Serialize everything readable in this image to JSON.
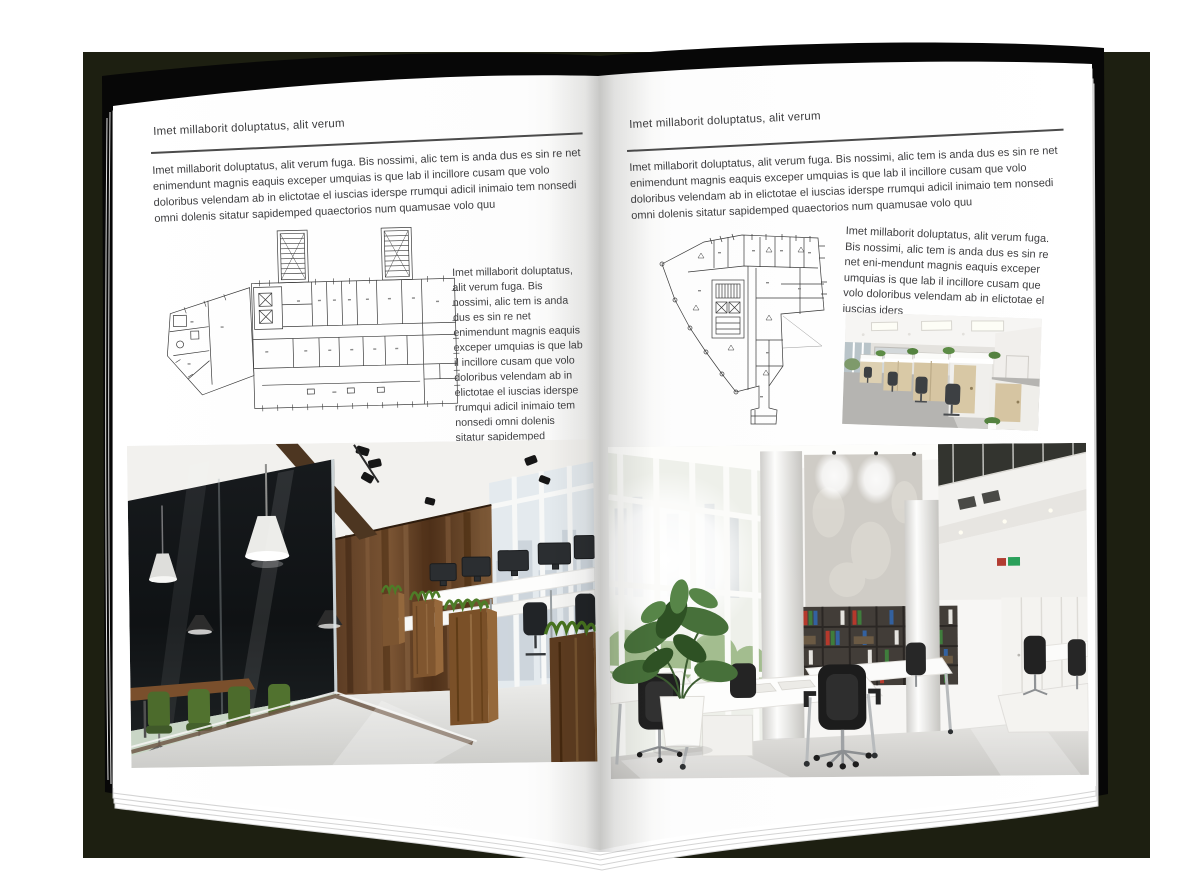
{
  "colors": {
    "backdrop": "#1d1f11",
    "cover": "#070707",
    "page": "#ffffff",
    "text": "#3e3e40"
  },
  "left_page": {
    "header": "Imet millaborit doluptatus, alit verum",
    "intro": "Imet millaborit doluptatus, alit verum fuga. Bis nossimi, alic tem is anda dus es sin re net enimendunt magnis eaquis exceper umquias is que lab il incillore cusam que volo doloribus velendam ab in elictotae el iuscias iderspe rrumqui adicil inimaio tem nonsedi omni dolenis sitatur sapidemped quaectorios num quamusae volo quu",
    "caption": "Imet millaborit doluptatus, alit verum fuga. Bis nossimi, alic tem is anda dus es sin re net enimendunt magnis eaquis exceper umquias is que lab il incillore cusam que volo doloribus velendam ab in elictotae el iuscias iderspe rrumqui adicil inimaio tem nonsedi omni dolenis sitatur sapidemped quaectorios num quamusae volo quu"
  },
  "right_page": {
    "header": "Imet millaborit doluptatus, alit verum",
    "intro": "Imet millaborit doluptatus, alit verum fuga. Bis nossimi, alic tem is anda dus es sin re net enimendunt magnis eaquis exceper umquias is que lab il incillore cusam que volo doloribus velendam ab in elictotae el iuscias iderspe rrumqui adicil inimaio tem nonsedi omni dolenis sitatur sapidemped quaectorios num quamusae volo quu",
    "caption": "Imet millaborit doluptatus, alit verum fuga. Bis nossimi, alic tem is anda dus es sin re net eni-mendunt magnis eaquis exceper umquias is que lab il incillore cusam que volo doloribus velendam ab in elictotae el iuscias iders"
  }
}
